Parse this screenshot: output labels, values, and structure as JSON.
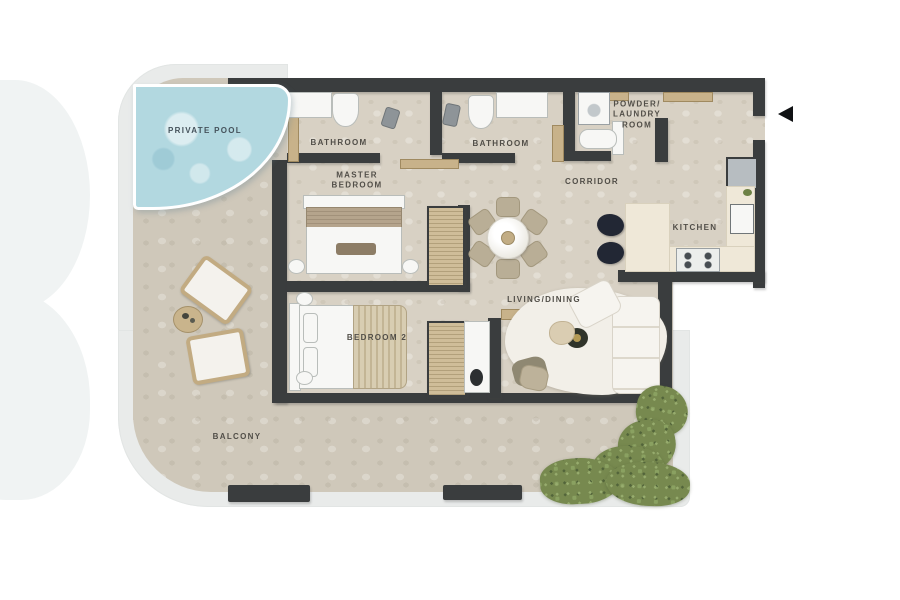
{
  "title": "Apartment floor plan with private pool and balcony",
  "labels": {
    "private_pool": {
      "text": "PRIVATE POOL"
    },
    "bathroom_1": {
      "text": "BATHROOM"
    },
    "bathroom_2": {
      "text": "BATHROOM"
    },
    "powder_laundry": {
      "lines": [
        "POWDER/",
        "LAUNDRY",
        "ROOM"
      ]
    },
    "master_bedroom": {
      "lines": [
        "MASTER",
        "BEDROOM"
      ]
    },
    "corridor": {
      "text": "CORRIDOR"
    },
    "kitchen": {
      "text": "KITCHEN"
    },
    "living_dining": {
      "text": "LIVING/DINING"
    },
    "bedroom_2": {
      "text": "BEDROOM 2"
    },
    "balcony": {
      "text": "BALCONY"
    }
  },
  "icons": {
    "entrance_arrow": "left-pointing-triangle"
  },
  "colors": {
    "wall": "#3a3d3e",
    "interior_floor": "#d8d1c4",
    "balcony_floor": "#cfc8ba",
    "railing_band": "#e9ebea",
    "pool_water": "#b2d8e0",
    "wood_tan": "#c8b28a",
    "counter_cream": "#efe8d8",
    "fixture_white": "#f7f7f5",
    "fridge_gray": "#b7bdc1",
    "stool_dark": "#222734",
    "hedge_green": "#77894f",
    "label_text": "#514e48",
    "arrow_black": "#101214",
    "background": "#ffffff"
  }
}
